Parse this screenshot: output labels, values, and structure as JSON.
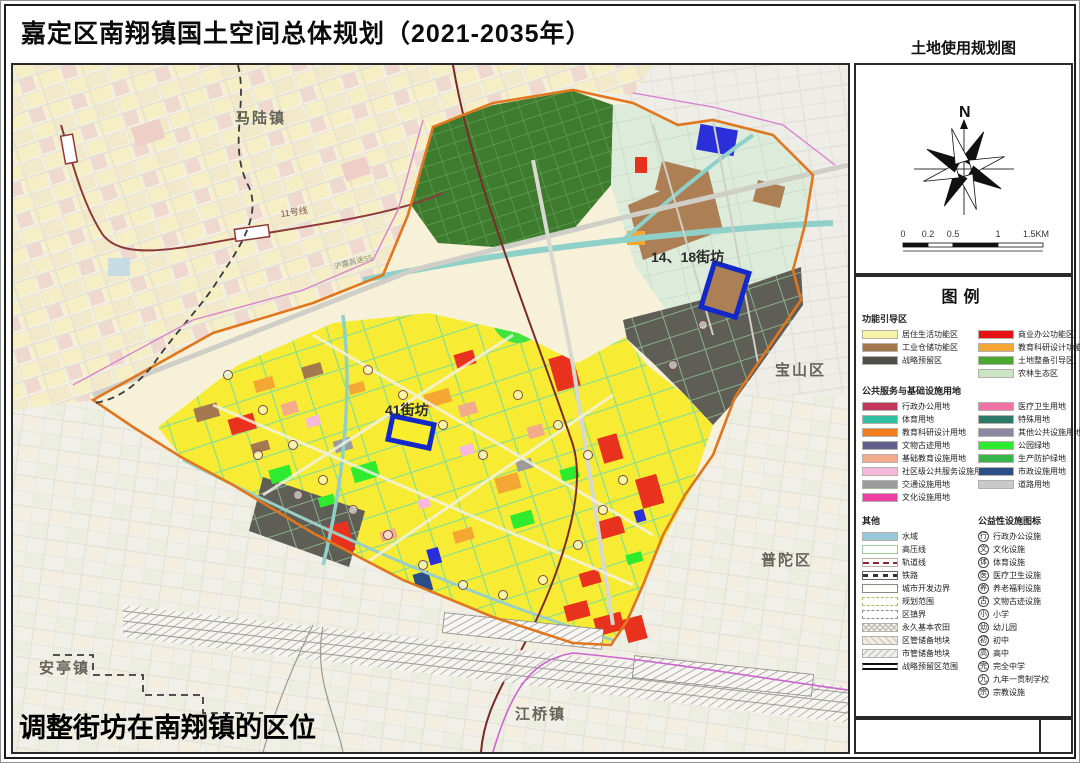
{
  "header": {
    "title": "嘉定区南翔镇国土空间总体规划（2021-2035年）",
    "map_type_label": "土地使用规划图"
  },
  "compass": {
    "north_label": "N"
  },
  "scale_bar": {
    "labels": [
      "0",
      "0.2",
      "0.5",
      "1",
      "1.5KM"
    ]
  },
  "map": {
    "region_labels": {
      "malu": "马陆镇",
      "baoshan": "宝山区",
      "putuo": "普陀区",
      "anting": "安亭镇",
      "jiangqiao": "江桥镇"
    },
    "line_labels": {
      "metro11": "11号线",
      "highway": "沪嘉高速S5"
    },
    "annotations": {
      "block_14_18": "14、18街坊",
      "block_41": "41街坊"
    },
    "caption": "调整街坊在南翔镇的区位"
  },
  "legend": {
    "title": "图例",
    "zones": {
      "heading": "功能引导区",
      "col1": [
        {
          "label": "居住生活功能区",
          "color": "#F7F3A6"
        },
        {
          "label": "工业仓储功能区",
          "color": "#A3784F"
        },
        {
          "label": "战略预留区",
          "color": "#4D4F48"
        }
      ],
      "col2": [
        {
          "label": "商业办公功能区",
          "color": "#E60F13"
        },
        {
          "label": "教育科研设计功能区",
          "color": "#F5A733"
        },
        {
          "label": "土地整备引导区",
          "color": "#4BA72F"
        },
        {
          "label": "农林生态区",
          "color": "#CBE4C4"
        }
      ]
    },
    "services": {
      "heading": "公共服务与基础设施用地",
      "col1": [
        {
          "label": "行政办公用地",
          "color": "#C2375B"
        },
        {
          "label": "体育用地",
          "color": "#30C2A0"
        },
        {
          "label": "教育科研设计用地",
          "color": "#F07D1E"
        },
        {
          "label": "文物古迹用地",
          "color": "#615E8E"
        },
        {
          "label": "基础教育设施用地",
          "color": "#F2AC8C"
        },
        {
          "label": "社区级公共服务设施用地",
          "color": "#F6B9DC"
        },
        {
          "label": "交通设施用地",
          "color": "#9B9B9B"
        },
        {
          "label": "文化设施用地",
          "color": "#EE3FA2"
        }
      ],
      "col2": [
        {
          "label": "医疗卫生用地",
          "color": "#F272A5"
        },
        {
          "label": "特殊用地",
          "color": "#2C7A67"
        },
        {
          "label": "其他公共设施用地",
          "color": "#8B87A5"
        },
        {
          "label": "公园绿地",
          "color": "#2FEB2F"
        },
        {
          "label": "生产防护绿地",
          "color": "#37B54A"
        },
        {
          "label": "市政设施用地",
          "color": "#2C4E87"
        },
        {
          "label": "道路用地",
          "color": "#C9C9C9"
        }
      ]
    },
    "other": {
      "heading": "其他",
      "items": [
        {
          "label": "水域",
          "style": "sw-water"
        },
        {
          "label": "高压线",
          "style": "sw-hv"
        },
        {
          "label": "轨道线",
          "style": "sw-metro"
        },
        {
          "label": "铁路",
          "style": "sw-rail"
        },
        {
          "label": "城市开发边界",
          "style": "sw-boundary"
        },
        {
          "label": "规划范围",
          "style": "sw-scope"
        },
        {
          "label": "区镇界",
          "style": "sw-district"
        },
        {
          "label": "永久基本农田",
          "style": "sw-farmland"
        },
        {
          "label": "区管储备地块",
          "style": "sw-reserve-district"
        },
        {
          "label": "市管储备地块",
          "style": "sw-reserve-city"
        },
        {
          "label": "战略预留区范围",
          "style": "sw-strategic"
        }
      ]
    },
    "icons": {
      "heading": "公益性设施图标",
      "items": [
        {
          "glyph": "行",
          "label": "行政办公设施"
        },
        {
          "glyph": "文",
          "label": "文化设施"
        },
        {
          "glyph": "体",
          "label": "体育设施"
        },
        {
          "glyph": "医",
          "label": "医疗卫生设施"
        },
        {
          "glyph": "养",
          "label": "养老福利设施"
        },
        {
          "glyph": "古",
          "label": "文物古迹设施"
        },
        {
          "glyph": "小",
          "label": "小学"
        },
        {
          "glyph": "幼",
          "label": "幼儿园"
        },
        {
          "glyph": "初",
          "label": "初中"
        },
        {
          "glyph": "高",
          "label": "高中"
        },
        {
          "glyph": "完",
          "label": "完全中学"
        },
        {
          "glyph": "九",
          "label": "九年一贯制学校"
        },
        {
          "glyph": "宗",
          "label": "宗教设施"
        }
      ]
    }
  }
}
